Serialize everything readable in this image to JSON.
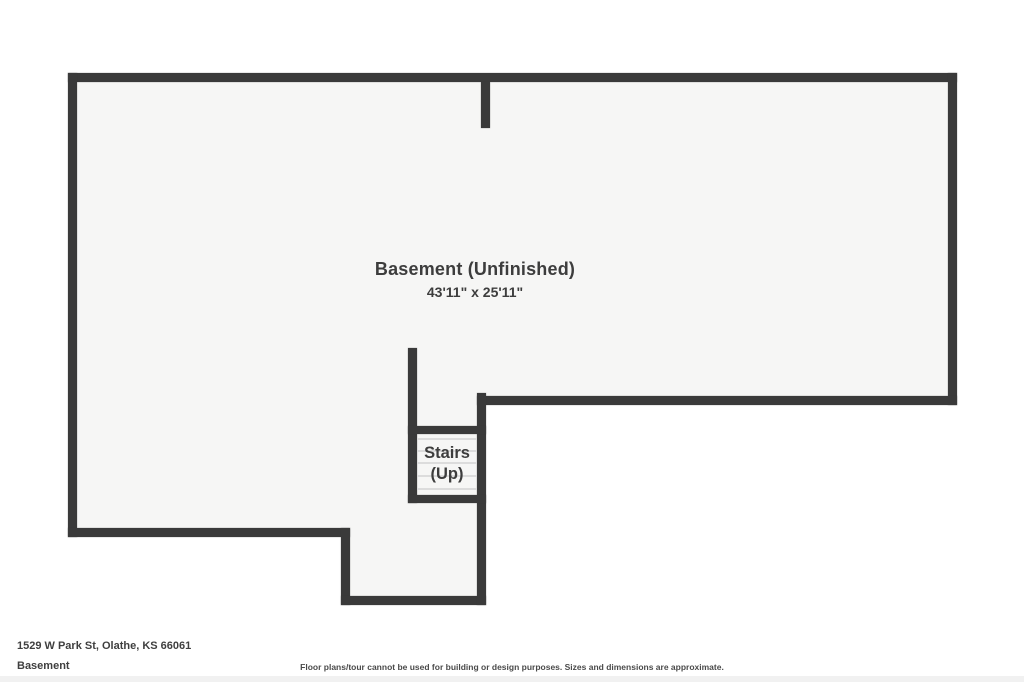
{
  "floorplan": {
    "room": {
      "label": "Basement (Unfinished)",
      "dimensions": "43'11\" x 25'11\""
    },
    "stairs": {
      "label_line1": "Stairs",
      "label_line2": "(Up)"
    },
    "colors": {
      "wall": "#3a3a3a",
      "floor_fill": "#f6f6f5",
      "background": "#ffffff",
      "label_text": "#3d3d3d",
      "tread_line": "#dcdcdc"
    }
  },
  "footer": {
    "address": "1529 W Park St, Olathe, KS 66061",
    "floor_name": "Basement",
    "disclaimer": "Floor plans/tour cannot be used for building or design purposes. Sizes and dimensions are approximate."
  }
}
